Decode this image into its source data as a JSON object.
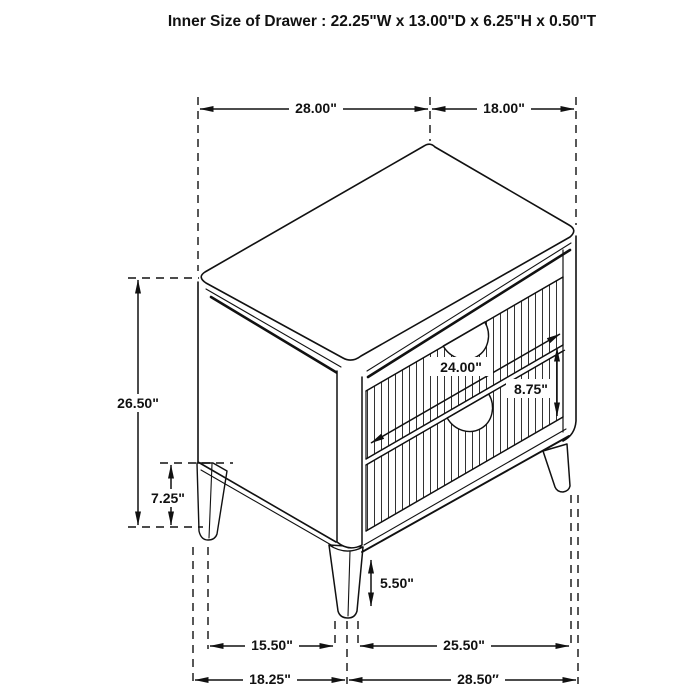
{
  "title": "Inner Size of Drawer : 22.25\"W x 13.00\"D x 6.25\"H x 0.50\"T",
  "dimensions": {
    "top_width": "28.00\"",
    "top_depth": "18.00\"",
    "overall_height": "26.50\"",
    "side_leg_height": "7.25\"",
    "drawer_front_width": "24.00\"",
    "drawer_front_height": "8.75\"",
    "front_leg_height": "5.50\"",
    "leg_span_side": "15.50\"",
    "leg_span_front": "25.50\"",
    "floor_span_side": "18.25\"",
    "floor_span_front": "28.50″"
  },
  "line_color": "#111111",
  "background_color": "#ffffff"
}
